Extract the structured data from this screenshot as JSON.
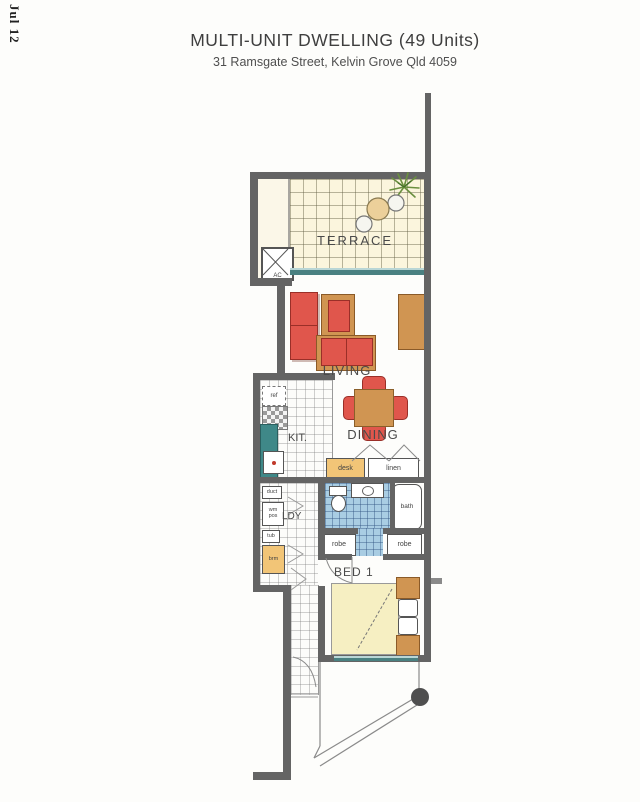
{
  "date_stamp": "Jul 12",
  "header": {
    "title": "MULTI-UNIT DWELLING (49 Units)",
    "subtitle": "31 Ramsgate Street, Kelvin Grove Qld 4059"
  },
  "rooms": {
    "terrace": "TERRACE",
    "living": "LIVING",
    "dining": "DINING",
    "kitchen": "KIT.",
    "laundry": "LDY",
    "bed1": "BED 1"
  },
  "fixtures": {
    "ac": "AC",
    "ref": "ref",
    "duct": "duct",
    "wm_pos": "wm pos",
    "tub": "tub",
    "brm": "brm",
    "desk": "desk",
    "linen": "linen",
    "robe_left": "robe",
    "robe_right": "robe",
    "bath": "bath"
  },
  "colors": {
    "wall": "#646464",
    "sofa_red": "#e0564c",
    "timber": "#d09552",
    "joinery_tan": "#f2c577",
    "bench_teal": "#3f8888",
    "bath_tile_blue": "#a9cde3",
    "bed_cream": "#f6efc2",
    "terrace_cream": "#fbf5dd",
    "window_teal": "#4a8181"
  }
}
